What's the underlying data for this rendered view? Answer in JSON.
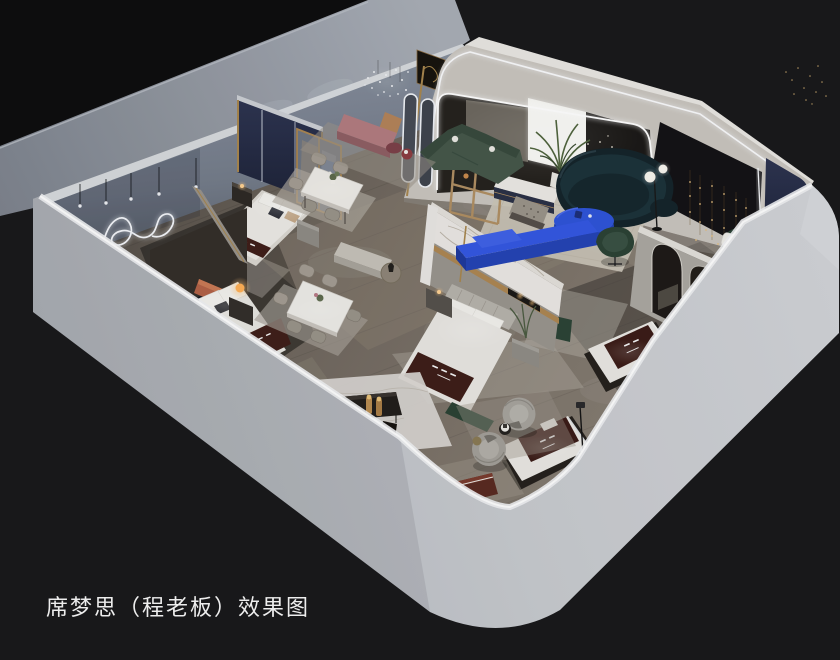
{
  "image": {
    "kind": "3d interior rendering",
    "style": "isometric dollhouse cutaway, roof removed, viewed from above",
    "subject": "Simmons mattress showroom with bedroom, dining and lounge displays"
  },
  "caption": {
    "text": "席梦思（程老板）效果图",
    "color": "#ededed",
    "position": "bottom-left"
  },
  "palette": {
    "background_black": "#141416",
    "backdrop_wall_gray": "#9aa0a9",
    "outer_wall_gray": "#c6c9ce",
    "wall_top_highlight": "#f0f1f3",
    "interior_wall_bluegray": "#78808d",
    "floor_wood": "#6e665d",
    "rug_cream": "#cbc5b8",
    "accent_royal_blue": "#2f55d9",
    "sofa_teal_navy": "#15252b",
    "sofa_green": "#46584a",
    "panel_navy": "#262d52",
    "headboard_navy": "#2b3149",
    "mattress_runner_brown": "#40201b",
    "brass_gold": "#ab8752",
    "marble_white": "#ebe8e4",
    "led_white": "#f2f5f9",
    "lamp_amber": "#ffb057",
    "bench_pink": "#b27c80",
    "feature_black_panel": "#141316",
    "string_lights_gold": "#e3bd7f"
  },
  "scene": {
    "shell": [
      "black void background",
      "gray backdrop wall",
      "outer showroom walls with lit top edges",
      "wood plank floor"
    ],
    "zones": [
      {
        "name": "bedroom-display-1",
        "items": [
          "navy upholstered headboard partition with brass frame and led lines",
          "double bed with white bedding and brown brand runner",
          "dark wood nightstand",
          "gray nightstand",
          "wavy neon wall light",
          "pendant bulb lights",
          "brass framed mirror partition"
        ]
      },
      {
        "name": "dining-display-1",
        "items": [
          "white marble dining table",
          "upholstered gray chairs",
          "area rug",
          "table plant"
        ]
      },
      {
        "name": "lounge-nook",
        "items": [
          "dusty pink bench",
          "burgundy pouf",
          "round burgundy side table",
          "crystal pendant light",
          "caramel cube seat",
          "gray rug"
        ]
      },
      {
        "name": "bedroom-display-2",
        "items": [
          "marble feature wall with brass band and display shelf",
          "channel tufted bed with brand runner",
          "nightstand with lamp",
          "nightstand with plant",
          "green foot bench",
          "area rug"
        ]
      },
      {
        "name": "bedroom-alcove-3",
        "items": [
          "terracotta headboard bed",
          "amber globe table lamp",
          "dark nightstand",
          "navy led headboard wall",
          "dark cabinet"
        ]
      },
      {
        "name": "dining-display-2",
        "items": [
          "white marble dining table",
          "six gray chairs",
          "area rug",
          "low bench and round wood side table"
        ]
      },
      {
        "name": "entry-lounge",
        "items": [
          "led arch facade with rounded corner",
          "two led outlined oval mirrors",
          "white backlit wall panel",
          "palm plant",
          "green sectional sofa",
          "dark teal curved sofa",
          "royal blue oval coffee table",
          "royal blue media console",
          "wood display cabinet",
          "white sideboard with navy front",
          "patterned ottoman",
          "globe floor lamp",
          "green swivel chair",
          "cream rug",
          "fairy string lights"
        ]
      },
      {
        "name": "gallery-corner",
        "items": [
          "black feature wall with gold string lights",
          "led edge strip",
          "navy rounded panel",
          "green armchair with white pillow",
          "small palm plant",
          "arched partition with two arch openings"
        ]
      },
      {
        "name": "mattress-displays",
        "items": [
          "floor mattress with brown brand runner 1",
          "floor mattress with brown brand runner 2",
          "maroon bench display"
        ]
      },
      {
        "name": "sitting-area",
        "items": [
          "two gray fluted barrel chairs",
          "round side table",
          "brass stool",
          "thin floor reading lamp",
          "gray rug"
        ]
      },
      {
        "name": "media-vignette",
        "items": [
          "white marble rug",
          "low dark media bench",
          "two brass cylinder lamps",
          "dark handbag"
        ]
      }
    ]
  }
}
